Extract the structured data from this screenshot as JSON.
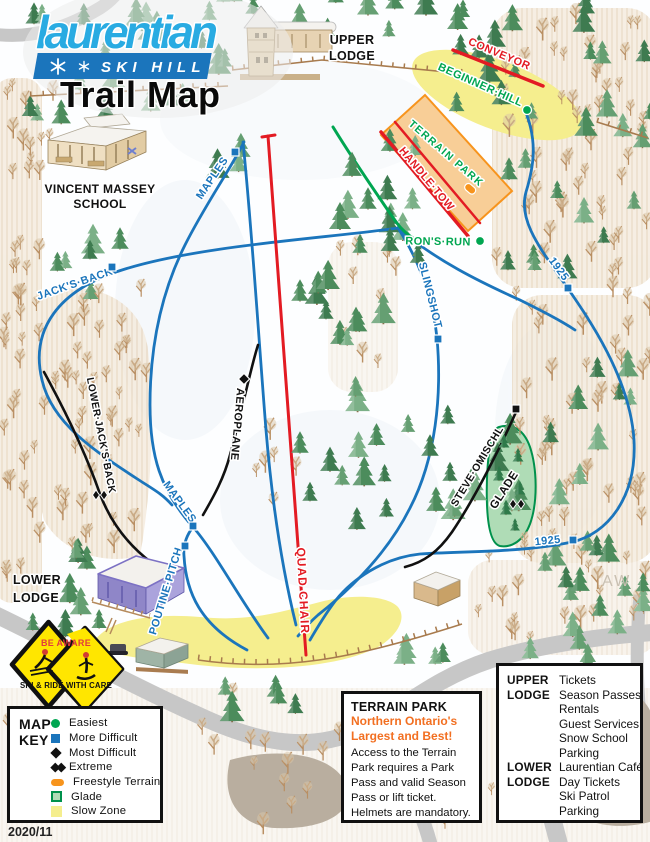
{
  "logo": {
    "name": "laurentian",
    "tagline": "SKI HILL",
    "map_title": "Trail Map"
  },
  "map_labels": {
    "upper_lodge_line1": "UPPER",
    "upper_lodge_line2": "LODGE",
    "school_line1": "VINCENT MASSEY",
    "school_line2": "SCHOOL",
    "lower_lodge_line1": "LOWER",
    "lower_lodge_line2": "LODGE",
    "artist_initials": "AW",
    "version": "2020/11"
  },
  "lifts": [
    {
      "name": "CONVEYOR"
    },
    {
      "name": "HANDLE·TOW"
    },
    {
      "name": "QUAD CHAIR"
    }
  ],
  "trails": [
    {
      "name": "BEGINNER·HILL",
      "difficulty": "easiest"
    },
    {
      "name": "RON'S·RUN",
      "difficulty": "easiest"
    },
    {
      "name": "TERRAIN PARK",
      "difficulty": "freestyle"
    },
    {
      "name": "1925",
      "difficulty": "more-difficult"
    },
    {
      "name": "SLINGSHOT",
      "difficulty": "more-difficult"
    },
    {
      "name": "JACK'S·BACK",
      "difficulty": "more-difficult"
    },
    {
      "name": "MAPLES",
      "difficulty": "more-difficult"
    },
    {
      "name": "POUTINE·PITCH",
      "difficulty": "more-difficult"
    },
    {
      "name": "AEROPLANE",
      "difficulty": "most-difficult"
    },
    {
      "name": "STEVE·OMISCHL",
      "difficulty": "most-difficult"
    },
    {
      "name": "LOWER·JACK'S·BACK",
      "difficulty": "extreme"
    },
    {
      "name": "GLADE",
      "difficulty": "extreme"
    }
  ],
  "sign": {
    "line1": "BE AWARE",
    "line2": "SKI & RIDE WITH CARE"
  },
  "legend": {
    "title_line1": "MAP",
    "title_line2": "KEY",
    "items": [
      {
        "label": "Easiest",
        "marker": "easiest"
      },
      {
        "label": "More Difficult",
        "marker": "more-difficult"
      },
      {
        "label": "Most Difficult",
        "marker": "most-difficult"
      },
      {
        "label": "Extreme",
        "marker": "extreme"
      },
      {
        "label": "Freestyle Terrain",
        "marker": "freestyle"
      },
      {
        "label": "Glade",
        "marker": "glade"
      },
      {
        "label": "Slow Zone",
        "marker": "slow-zone"
      }
    ]
  },
  "terrain_park_box": {
    "title": "TERRAIN PARK",
    "tagline_line1": "Northern Ontario's",
    "tagline_line2": "Largest and Best!",
    "body": "Access to the Terrain Park requires a Park Pass and valid Season Pass or lift ticket. Helmets are mandatory."
  },
  "lodge_services_box": {
    "rows": [
      {
        "lodge": "UPPER",
        "service": "Tickets"
      },
      {
        "lodge": "LODGE",
        "service": "Season Passes"
      },
      {
        "lodge": "",
        "service": "Rentals"
      },
      {
        "lodge": "",
        "service": "Guest Services"
      },
      {
        "lodge": "",
        "service": "Snow School"
      },
      {
        "lodge": "",
        "service": "Parking"
      },
      {
        "lodge": "LOWER",
        "service": "Laurentian Café"
      },
      {
        "lodge": "LODGE",
        "service": "Day Tickets"
      },
      {
        "lodge": "",
        "service": "Ski Patrol"
      },
      {
        "lodge": "",
        "service": "Parking"
      }
    ]
  },
  "colors": {
    "easiest_green": "#00A651",
    "more_difficult_blue": "#1B75BC",
    "lift_red": "#E31B23",
    "freestyle_orange": "#F7941D",
    "glade_fill": "#AFDCB6",
    "glade_border": "#00914C",
    "slow_zone_yellow": "#F5EE8E",
    "logo_blue": "#29ABE2",
    "logo_bar_blue": "#1B75BC",
    "sign_yellow": "#FFE600",
    "road_gray": "#C7C7C7",
    "parking_tan": "#B9AE9F"
  }
}
